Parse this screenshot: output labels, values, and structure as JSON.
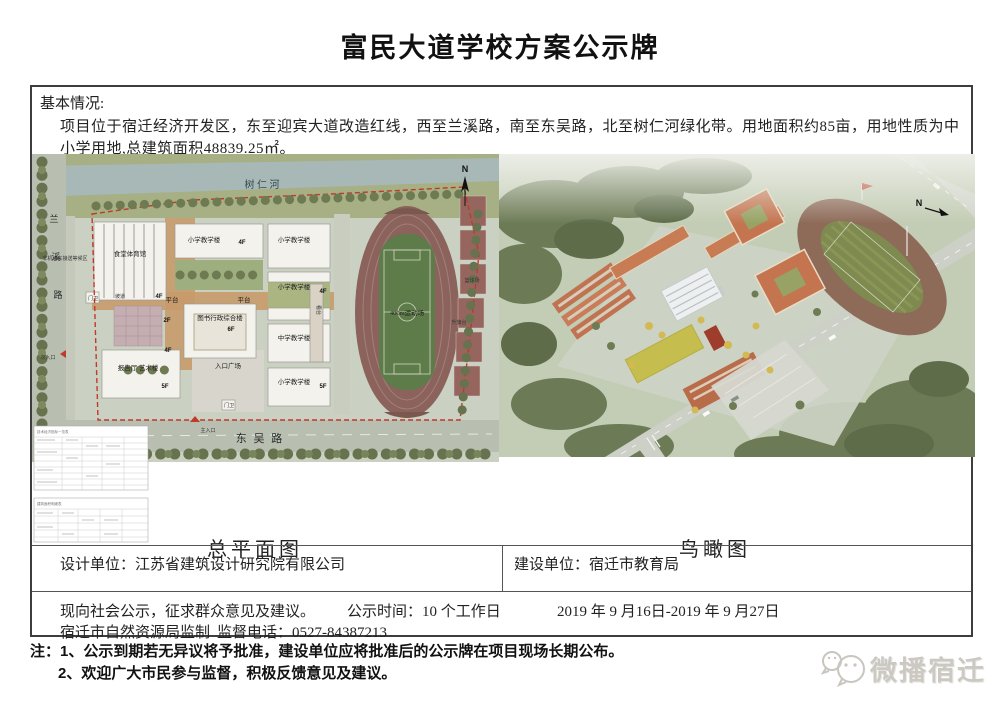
{
  "title": "富民大道学校方案公示牌",
  "colors": {
    "board_border": "#3d3d3d",
    "boundary_red": "#c0392b",
    "track_brown": "#8b625c",
    "field_green": "#5e7c49",
    "watermark_gray": "#ccc9c3"
  },
  "basic_info": {
    "label": "基本情况:",
    "text": "项目位于宿迁经济开发区，东至迎宾大道改造红线，西至兰溪路，南至东吴路，北至树仁河绿化带。用地面积约85亩，用地性质为中小学用地,总建筑面积48839.25㎡。"
  },
  "site_plan": {
    "caption": "总平面图",
    "north": "N",
    "river": "树 仁 河",
    "road_left": [
      "兰",
      "溪",
      "路"
    ],
    "road_bottom": "东 吴 路",
    "main_entrance": "主入口",
    "side_entrance": "次入口",
    "buildings": {
      "canteen_gym": "食堂体育馆",
      "primary": "小学教学楼",
      "middle": "中学教学楼",
      "library": "图书行政综合楼",
      "report_art": "报告厅 艺术楼",
      "guard": "门卫",
      "ramp": "坡道",
      "platform": "平台",
      "stand": "看台",
      "entry_plaza": "入口广场",
      "waiting_area": "非机动车接送等候区"
    },
    "floors": {
      "f2": "2F",
      "f4": "4F",
      "f5": "5F",
      "f6": "6F"
    },
    "sports": {
      "field": "400m运动场",
      "flag_stage": "升旗台",
      "basketball": "篮球场"
    },
    "tables": {
      "t1": "技术经济指标一览表",
      "t2": "建筑面积明细表"
    }
  },
  "aerial": {
    "caption": "鸟瞰图",
    "north": "N"
  },
  "units": {
    "design_label": "设计单位：",
    "design_value": "江苏省建筑设计研究院有限公司",
    "build_label": "建设单位：",
    "build_value": "宿迁市教育局"
  },
  "notice": {
    "statement": "现向社会公示，征求群众意见及建议。",
    "duration_label": "公示时间：10 个工作日",
    "date_range": "2019 年 9 月16日-2019 年 9 月27日",
    "supervisor": "宿迁市自然资源局监制",
    "phone": "监督电话：0527-84387213"
  },
  "notes": {
    "item1": "注：1、公示到期若无异议将予批准，建设单位应将批准后的公示牌在项目现场长期公布。",
    "item2": "2、欢迎广大市民参与监督，积极反馈意见及建议。"
  },
  "watermark": {
    "text": "微播宿迁"
  }
}
